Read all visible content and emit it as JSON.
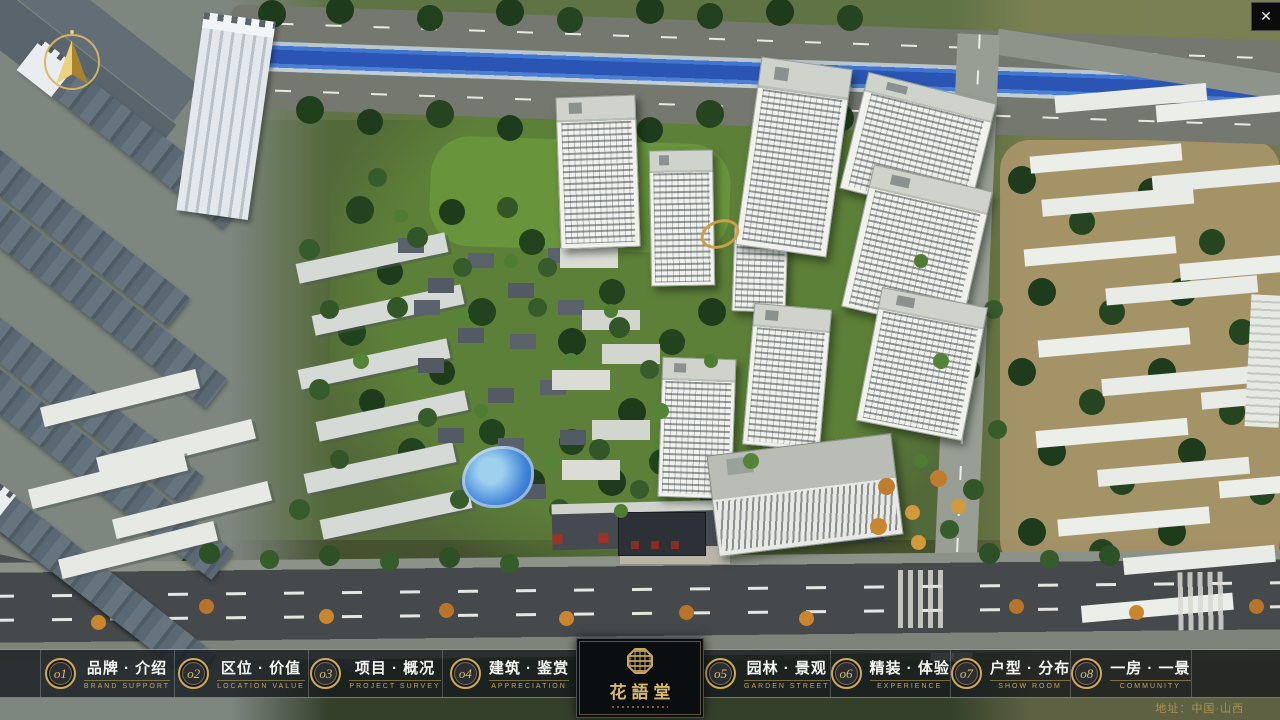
{
  "window": {
    "close_icon": "✕"
  },
  "nav": {
    "items": [
      {
        "num": "o1",
        "label": "品牌 · 介绍",
        "sublabel": "BRAND SUPPORT"
      },
      {
        "num": "o2",
        "label": "区位 · 价值",
        "sublabel": "LOCATION VALUE"
      },
      {
        "num": "o3",
        "label": "项目 · 概况",
        "sublabel": "PROJECT SURVEY"
      },
      {
        "num": "o4",
        "label": "建筑 · 鉴赏",
        "sublabel": "APPRECIATION"
      },
      {
        "num": "o5",
        "label": "园林 · 景观",
        "sublabel": "GARDEN STREET"
      },
      {
        "num": "o6",
        "label": "精装 · 体验",
        "sublabel": "EXPERIENCE"
      },
      {
        "num": "o7",
        "label": "户型 · 分布",
        "sublabel": "SHOW ROOM"
      },
      {
        "num": "o8",
        "label": "一房 · 一景",
        "sublabel": "COMMUNITY"
      }
    ]
  },
  "logo": {
    "title": "花語堂"
  },
  "footer": {
    "address": "地址：中国·山西"
  },
  "colors": {
    "gold": "#c9a75c",
    "bar_background": "rgba(22,26,30,0.8)",
    "river_blue": "#2a55b4",
    "storefront_red": "#9e3128"
  }
}
